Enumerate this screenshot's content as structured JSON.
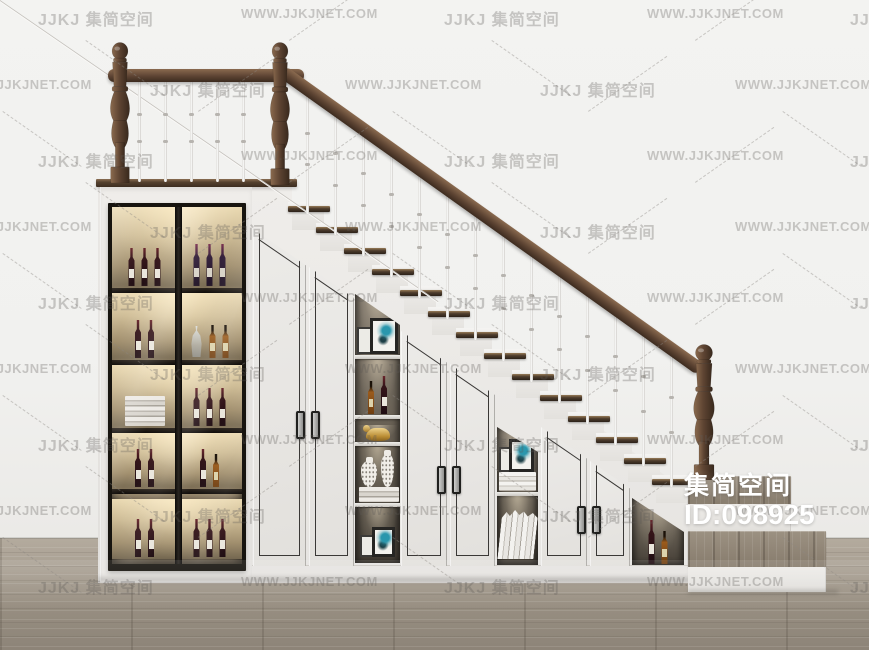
{
  "badge": {
    "brand": "集简空间",
    "id": "ID:098925"
  },
  "watermark": {
    "logo": "JJKJ 集简空间",
    "url": "WWW.JJKJNET.COM"
  },
  "scene": {
    "stairs": {
      "step_count": 14,
      "bottom_wide_steps": 2
    },
    "railing": {
      "stair_spindles": 14,
      "landing_spindles": 5,
      "newels": 3
    },
    "wine_cabinet": {
      "shelves": [
        {
          "left": [
            "wine",
            "wine",
            "wine"
          ],
          "right": [
            "wine-purple",
            "wine-purple",
            "wine-purple"
          ]
        },
        {
          "left": [
            "wine",
            "wine"
          ],
          "right": [
            "decanter",
            "whiskey",
            "whiskey"
          ]
        },
        {
          "left": [
            "books"
          ],
          "right": [
            "wine",
            "wine",
            "wine"
          ]
        },
        {
          "left": [
            "wine",
            "wine"
          ],
          "right": [
            "wine",
            "whiskey"
          ]
        },
        {
          "left": [
            "wine",
            "wine"
          ],
          "right": [
            "wine",
            "wine",
            "wine"
          ]
        }
      ]
    },
    "niches": [
      {
        "sections": [
          [
            "frame-duo"
          ],
          [
            "whiskey",
            "wine"
          ],
          [
            "figurine"
          ],
          [
            "vase-duo"
          ],
          [
            "frame-duo-sm"
          ]
        ]
      },
      {
        "sections": [
          [
            "frame-stack"
          ],
          [
            "books-lean"
          ]
        ]
      },
      {
        "sections": [
          [
            "wine-tall",
            "whiskey"
          ]
        ]
      }
    ],
    "colors": {
      "wall": "#f2f2f0",
      "floor": "#a29a8e",
      "cabinet_white": "#eae8e5",
      "rail_wood": "#5d4433",
      "tread_wood": "#3f3227",
      "interior_glow": "#e6d6ae"
    }
  }
}
